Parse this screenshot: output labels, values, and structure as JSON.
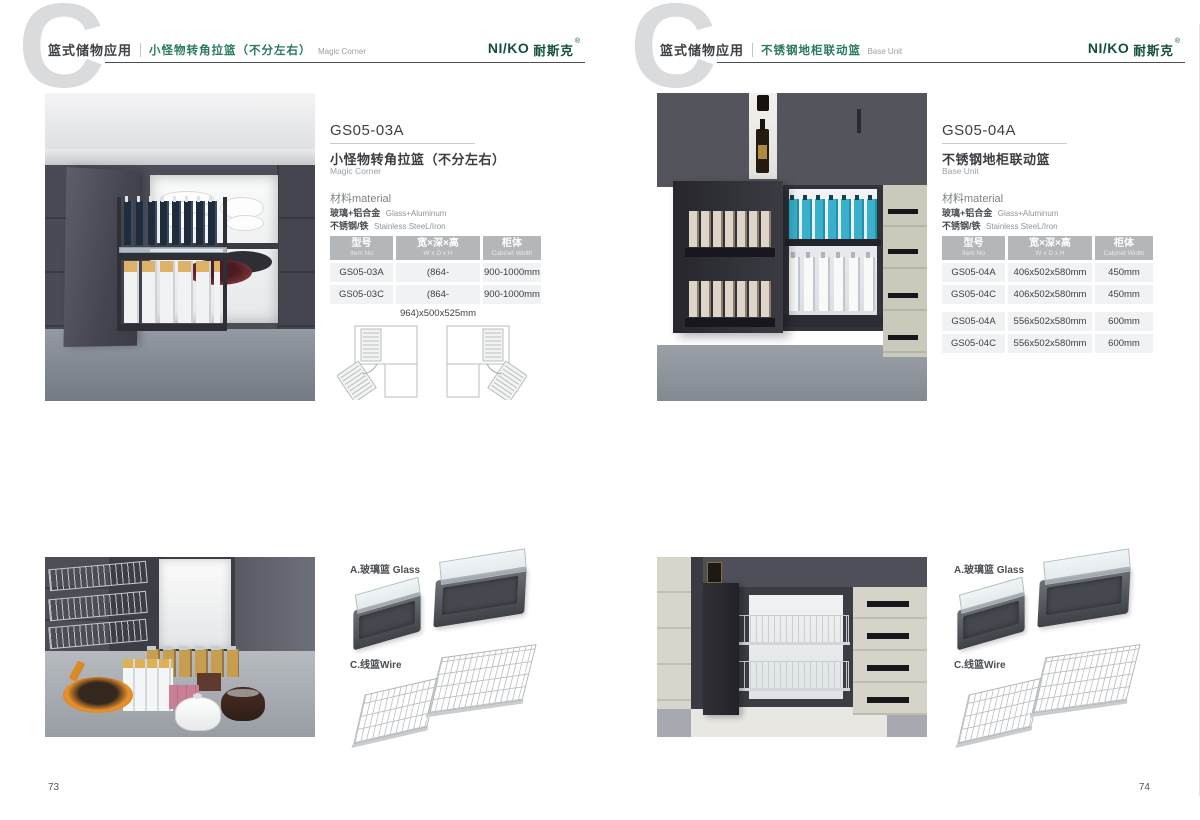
{
  "brand": {
    "logo_en": "NI/KO",
    "logo_cn": "耐斯克",
    "reg": "®",
    "green": "#14503c"
  },
  "pages": [
    {
      "header": {
        "category": "篮式储物应用",
        "subtitle_cn": "小怪物转角拉篮（不分左右）",
        "subtitle_en": "Magic Corner"
      },
      "product": {
        "code": "GS05-03A",
        "name_cn": "小怪物转角拉篮（不分左右）",
        "name_en": "Magic Corner",
        "material_label": "材料material",
        "materials": [
          {
            "cn": "玻璃+铝合金",
            "en": "Glass+Aluminum"
          },
          {
            "cn": "不锈钢/铁",
            "en": "Stainless SteeL/Iron"
          }
        ]
      },
      "table": {
        "headers": [
          {
            "cn": "型号",
            "en": "Item No"
          },
          {
            "cn": "宽×深×高",
            "en": "W x D x H"
          },
          {
            "cn": "柜体",
            "en": "Cabinet Width"
          }
        ],
        "rows": [
          [
            "GS05-03A",
            "(864-964)x500x525mm",
            "900-1000mm"
          ],
          [
            "GS05-03C",
            "(864-964)x500x525mm",
            "900-1000mm"
          ]
        ]
      },
      "basket_types": [
        {
          "label": "A.玻璃篮 Glass"
        },
        {
          "label": "C.线篮Wire"
        }
      ],
      "page_number": "73"
    },
    {
      "header": {
        "category": "篮式储物应用",
        "subtitle_cn": "不锈钢地柜联动篮",
        "subtitle_en": "Base Unit"
      },
      "product": {
        "code": "GS05-04A",
        "name_cn": "不锈钢地柜联动篮",
        "name_en": "Base Unit",
        "material_label": "材料material",
        "materials": [
          {
            "cn": "玻璃+铝合金",
            "en": "Glass+Aluminum"
          },
          {
            "cn": "不锈钢/铁",
            "en": "Stainless SteeL/Iron"
          }
        ]
      },
      "table": {
        "headers": [
          {
            "cn": "型号",
            "en": "Item No"
          },
          {
            "cn": "宽×深×高",
            "en": "W x D x H"
          },
          {
            "cn": "柜体",
            "en": "Cabinet Width"
          }
        ],
        "rows": [
          [
            "GS05-04A",
            "406x502x580mm",
            "450mm"
          ],
          [
            "GS05-04C",
            "406x502x580mm",
            "450mm"
          ],
          [
            "GS05-04A",
            "556x502x580mm",
            "600mm"
          ],
          [
            "GS05-04C",
            "556x502x580mm",
            "600mm"
          ]
        ]
      },
      "basket_types": [
        {
          "label": "A.玻璃篮 Glass"
        },
        {
          "label": "C.线篮Wire"
        }
      ],
      "page_number": "74"
    }
  ]
}
